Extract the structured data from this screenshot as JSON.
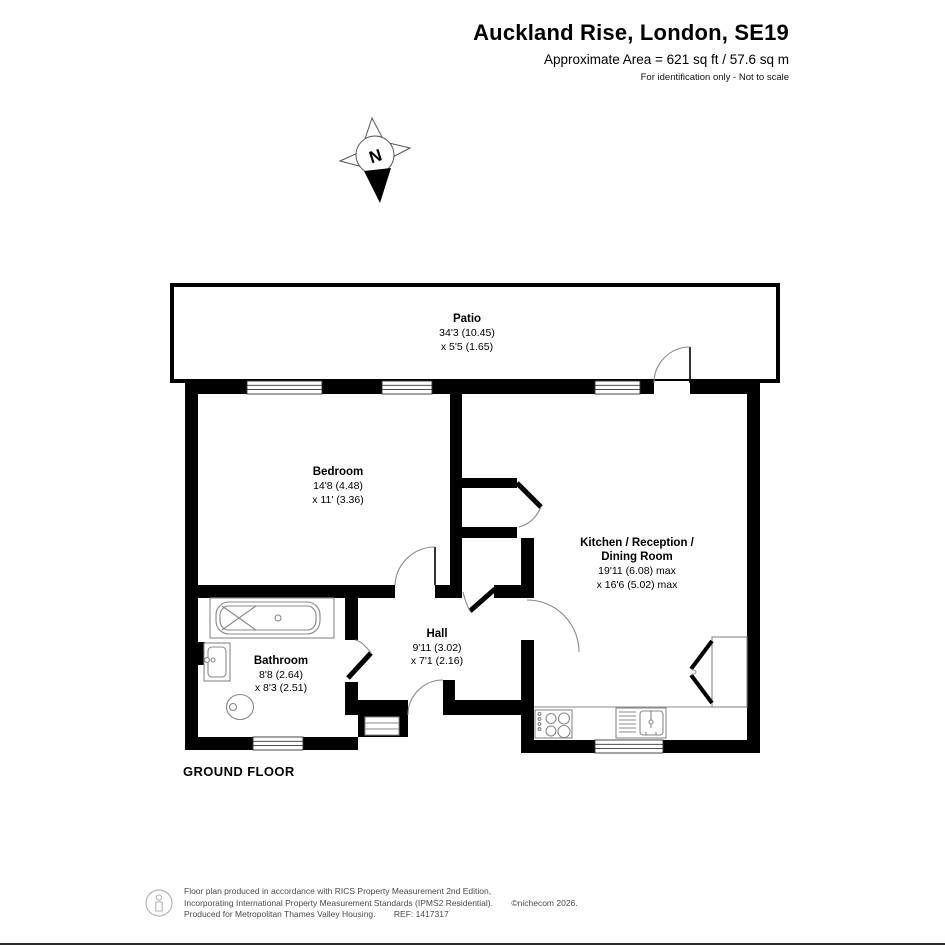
{
  "header": {
    "title": "Auckland Rise, London, SE19",
    "area": "Approximate Area = 621 sq ft / 57.6 sq m",
    "disclaimer": "For identification only - Not to scale"
  },
  "compass": {
    "north_label": "N"
  },
  "rooms": {
    "patio": {
      "name": "Patio",
      "dim1": "34'3 (10.45)",
      "dim2": "x 5'5 (1.65)"
    },
    "bedroom": {
      "name": "Bedroom",
      "dim1": "14'8 (4.48)",
      "dim2": "x 11' (3.36)"
    },
    "kitchen": {
      "name1": "Kitchen / Reception /",
      "name2": "Dining Room",
      "dim1": "19'11 (6.08) max",
      "dim2": "x 16'6 (5.02) max"
    },
    "bathroom": {
      "name": "Bathroom",
      "dim1": "8'8 (2.64)",
      "dim2": "x 8'3 (2.51)"
    },
    "hall": {
      "name": "Hall",
      "dim1": "9'11 (3.02)",
      "dim2": "x 7'1 (2.16)"
    }
  },
  "floor_label": "GROUND FLOOR",
  "footer": {
    "line1": "Floor plan produced in accordance with RICS Property Measurement 2nd Edition,",
    "line2": "Incorporating International Property Measurement Standards (IPMS2 Residential).",
    "copyright": "©nichecom 2026.",
    "line3": "Produced for Metropolitan Thames Valley Housing.",
    "ref": "REF: 1417317"
  },
  "colors": {
    "wall": "#000000",
    "background": "#ffffff",
    "fixture": "#888888",
    "footer_text": "#4a4a4a"
  }
}
